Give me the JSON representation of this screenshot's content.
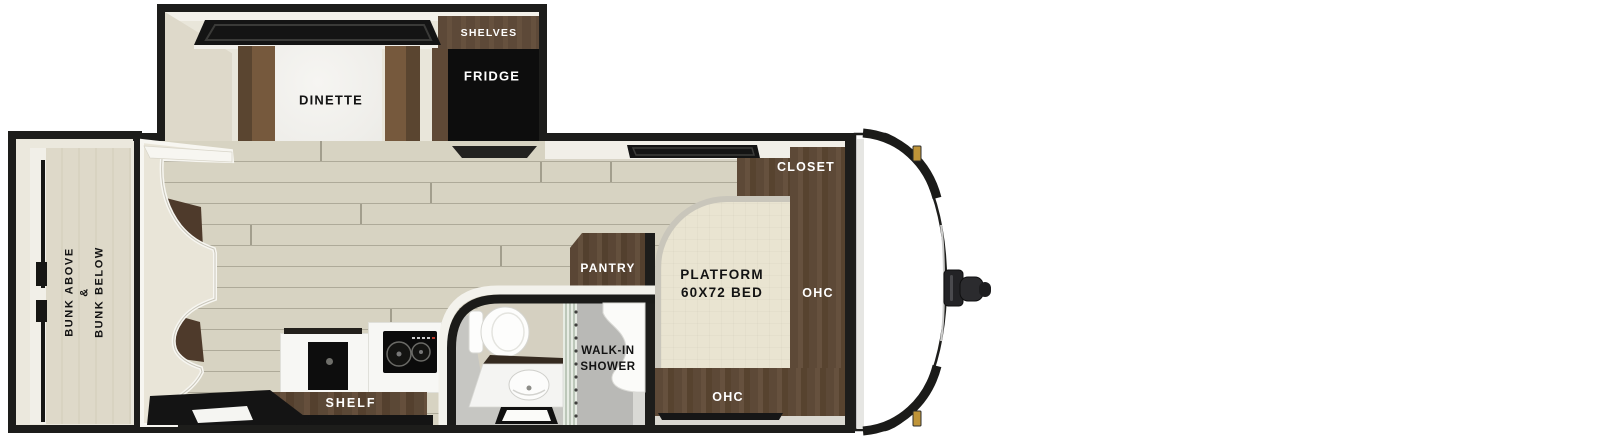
{
  "floorplan": {
    "slide_out": {
      "shelves": "SHELVES",
      "fridge": "FRIDGE",
      "dinette": "DINETTE"
    },
    "bunk_room": {
      "label_lines": [
        "BUNK ABOVE",
        "&",
        "BUNK BELOW"
      ]
    },
    "bedroom": {
      "closet": "CLOSET",
      "bed_line1": "PLATFORM",
      "bed_line2": "60X72 BED",
      "ohc_right": "OHC",
      "ohc_bottom": "OHC"
    },
    "bathroom": {
      "pantry": "PANTRY",
      "shower_line1": "WALK-IN",
      "shower_line2": "SHOWER"
    },
    "kitchen": {
      "shelf": "SHELF"
    },
    "colors": {
      "outline": "#1d1d1b",
      "wood_floor": "#d7d3c2",
      "cabinet_brown": "#5d4937",
      "bench_brown": "#76593d",
      "bed_cream": "#e9e4d1",
      "bath_gray": "#c6c6c2",
      "accent_gold": "#bf9438",
      "appliance_black": "#0d0d0d"
    }
  }
}
